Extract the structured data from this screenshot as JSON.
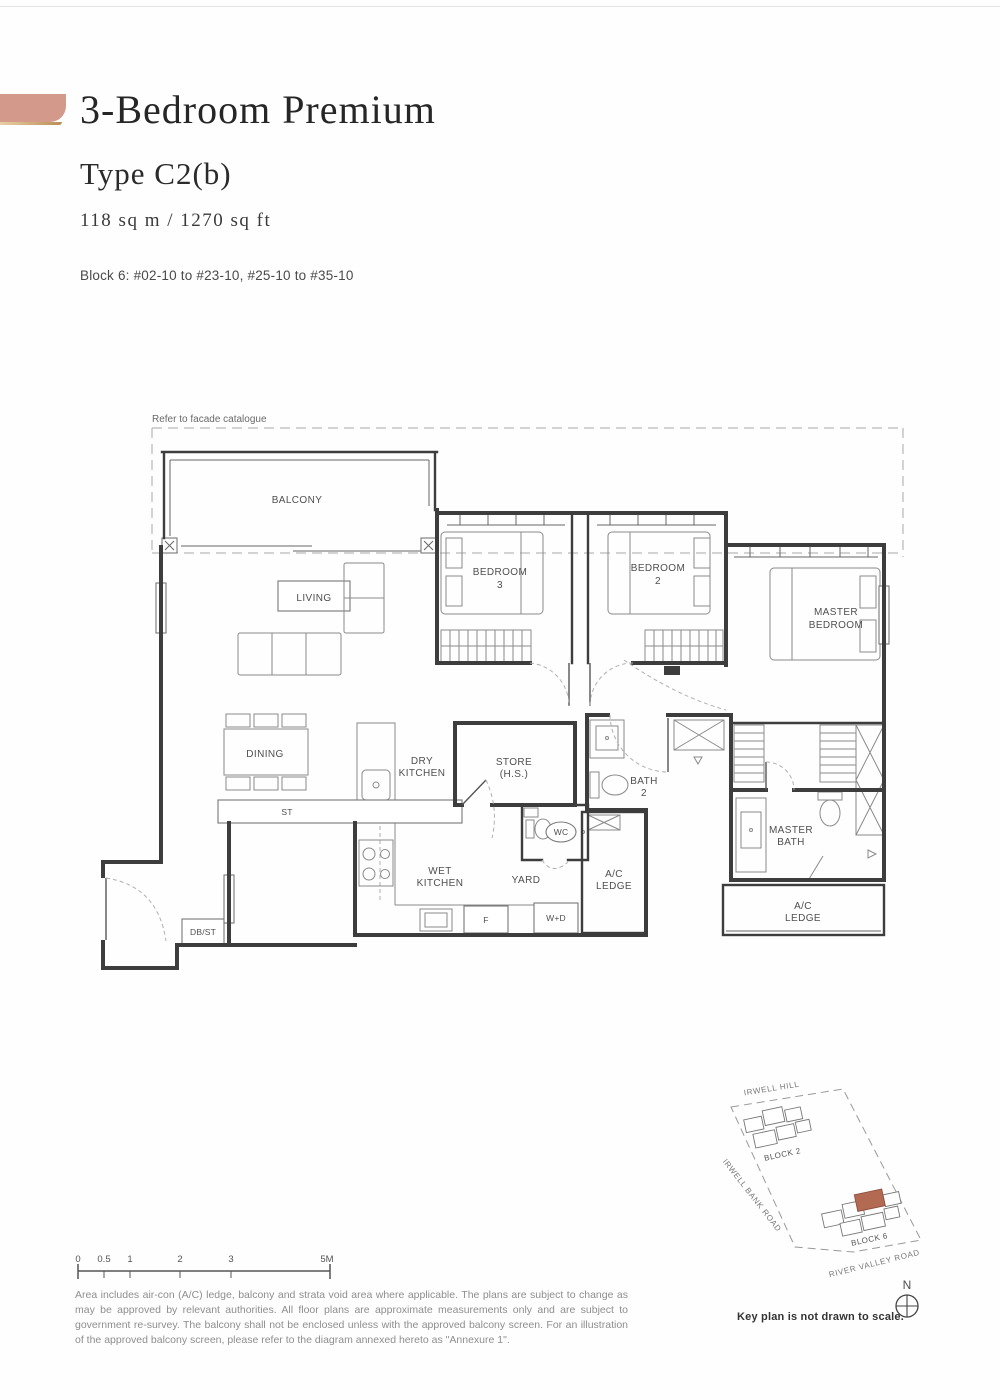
{
  "header": {
    "title": "3-Bedroom Premium",
    "type": "Type C2(b)",
    "area": "118 sq m / 1270 sq ft",
    "units": "Block 6: #02-10 to #23-10, #25-10 to #35-10"
  },
  "floor_plan": {
    "facade_note": "Refer to facade catalogue",
    "labels": {
      "balcony": "BALCONY",
      "living": "LIVING",
      "bedroom3_1": "BEDROOM",
      "bedroom3_2": "3",
      "bedroom2_1": "BEDROOM",
      "bedroom2_2": "2",
      "master_bedroom_1": "MASTER",
      "master_bedroom_2": "BEDROOM",
      "dining": "DINING",
      "dry_kitchen_1": "DRY",
      "dry_kitchen_2": "KITCHEN",
      "store_1": "STORE",
      "store_2": "(H.S.)",
      "bath2_1": "BATH",
      "bath2_2": "2",
      "wc": "WC",
      "wet_kitchen_1": "WET",
      "wet_kitchen_2": "KITCHEN",
      "yard": "YARD",
      "ac_ledge_1": "A/C",
      "ac_ledge_2": "LEDGE",
      "master_bath_1": "MASTER",
      "master_bath_2": "BATH",
      "st": "ST",
      "db_st": "DB/ST",
      "fridge": "F",
      "washer_dryer": "W+D"
    }
  },
  "scale_bar": {
    "ticks": [
      "0",
      "0.5",
      "1",
      "2",
      "3",
      "5M"
    ]
  },
  "disclaimer": "Area includes air-con (A/C) ledge, balcony and strata void area where applicable. The plans are subject to change as may be approved by relevant authorities. All floor plans are approximate measurements only and are subject to government re-survey. The balcony shall not be enclosed unless with the approved balcony screen. For an illustration of the approved balcony screen, please refer to the diagram annexed hereto as \"Annexure 1\".",
  "key_plan": {
    "roads": {
      "irwell_hill": "IRWELL HILL",
      "irwell_bank_road": "IRWELL BANK ROAD",
      "river_valley_road": "RIVER VALLEY ROAD"
    },
    "blocks": {
      "block2": "BLOCK 2",
      "block6": "BLOCK 6"
    },
    "north": "N",
    "caption": "Key plan is not drawn to scale.",
    "highlight_color": "#b26b52"
  },
  "colors": {
    "accent_bar": "#d39a8c",
    "accent_gold": "#c8a064",
    "line": "#3d3d3d"
  }
}
